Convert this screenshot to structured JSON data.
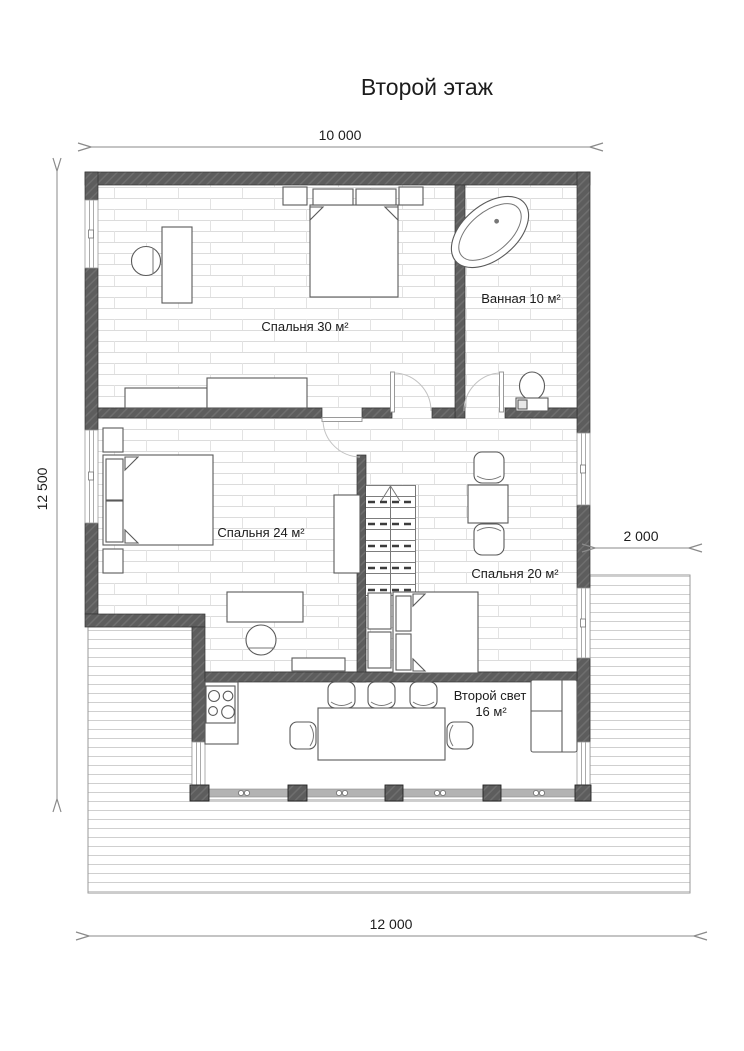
{
  "title": "Второй этаж",
  "dimensions": {
    "top": "10 000",
    "left": "12 500",
    "right": "2 000",
    "bottom": "12 000"
  },
  "rooms": {
    "bedroom30": {
      "label": "Спальня 30 м²"
    },
    "bathroom": {
      "label": "Ванная 10 м²"
    },
    "bedroom24": {
      "label": "Спальня 24 м²"
    },
    "bedroom20": {
      "label": "Спальня 20 м²"
    },
    "second_light": {
      "label": "Второй свет",
      "area": "16 м²"
    }
  },
  "colors": {
    "wall": "#5d5d5d",
    "wall_hatch": "#6e6e6e",
    "floor_line": "#dcdcdc",
    "deck_line": "#cfcfcf",
    "furniture_stroke": "#5a5a5a",
    "dimension_line": "#8a8a8a",
    "text": "#1c1c1c"
  }
}
